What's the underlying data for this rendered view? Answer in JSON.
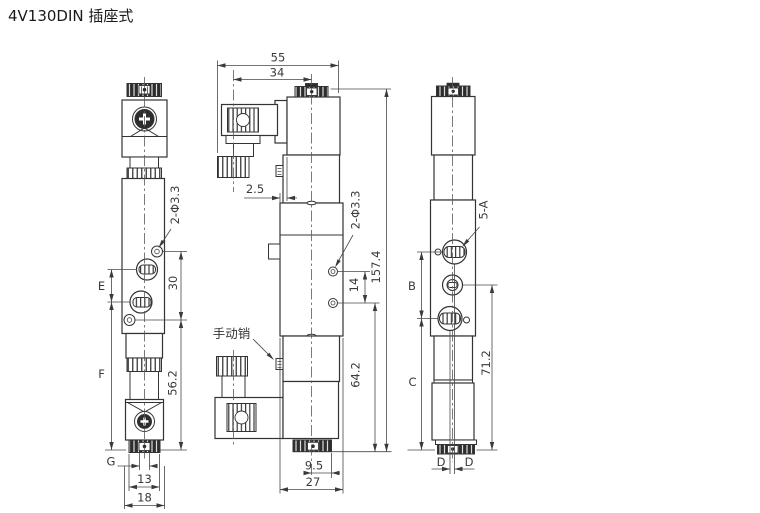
{
  "title": "4V130DIN 插座式",
  "colors": {
    "line": "#333333",
    "text": "#3a3a3a",
    "dark_fill": "#2d2d2d",
    "background": "#ffffff"
  },
  "views": {
    "front": {
      "hole_callout": "2-Φ3.3",
      "dim_port_spacing": "E",
      "dim_hole_spacing": "30",
      "dim_body_height": "F",
      "dim_lower_height": "56.2",
      "dim_pin_width": "G",
      "dim_cap_width": "13",
      "dim_body_width": "18"
    },
    "side": {
      "dim_total_width": "55",
      "dim_connector_offset": "34",
      "dim_edge_offset": "2.5",
      "hole_callout": "2-Φ3.3",
      "dim_hole_spacing": "14",
      "dim_total_height": "157.4",
      "dim_lower_height": "64.2",
      "manual_pin_label": "手动销",
      "dim_center_offset": "9.5",
      "dim_body_depth": "27"
    },
    "rear": {
      "port_callout": "5-A",
      "dim_port_span": "B",
      "dim_lower_span": "C",
      "dim_port_height": "71.2",
      "dim_left_offset": "D",
      "dim_right_offset": "D"
    }
  }
}
